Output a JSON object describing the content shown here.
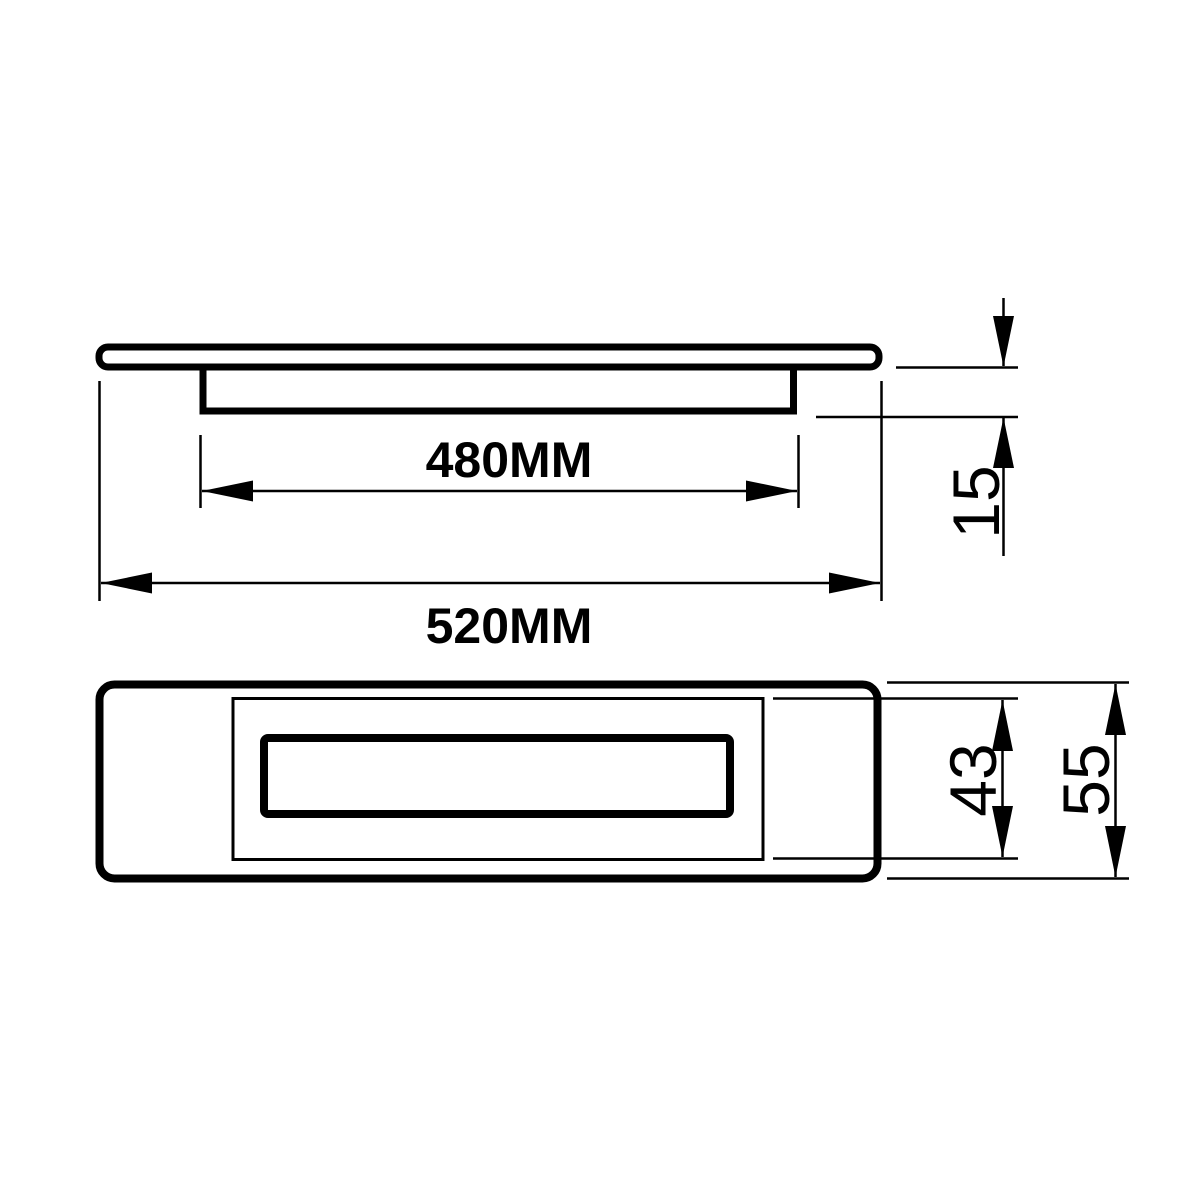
{
  "colors": {
    "line": "#000000",
    "background": "#ffffff"
  },
  "views": {
    "side_profile": {
      "labels": {
        "recess_width": "480MM",
        "overall_width": "520MM",
        "depth": "15"
      }
    },
    "front_face": {
      "labels": {
        "recess_height": "43",
        "overall_height": "55"
      }
    }
  }
}
